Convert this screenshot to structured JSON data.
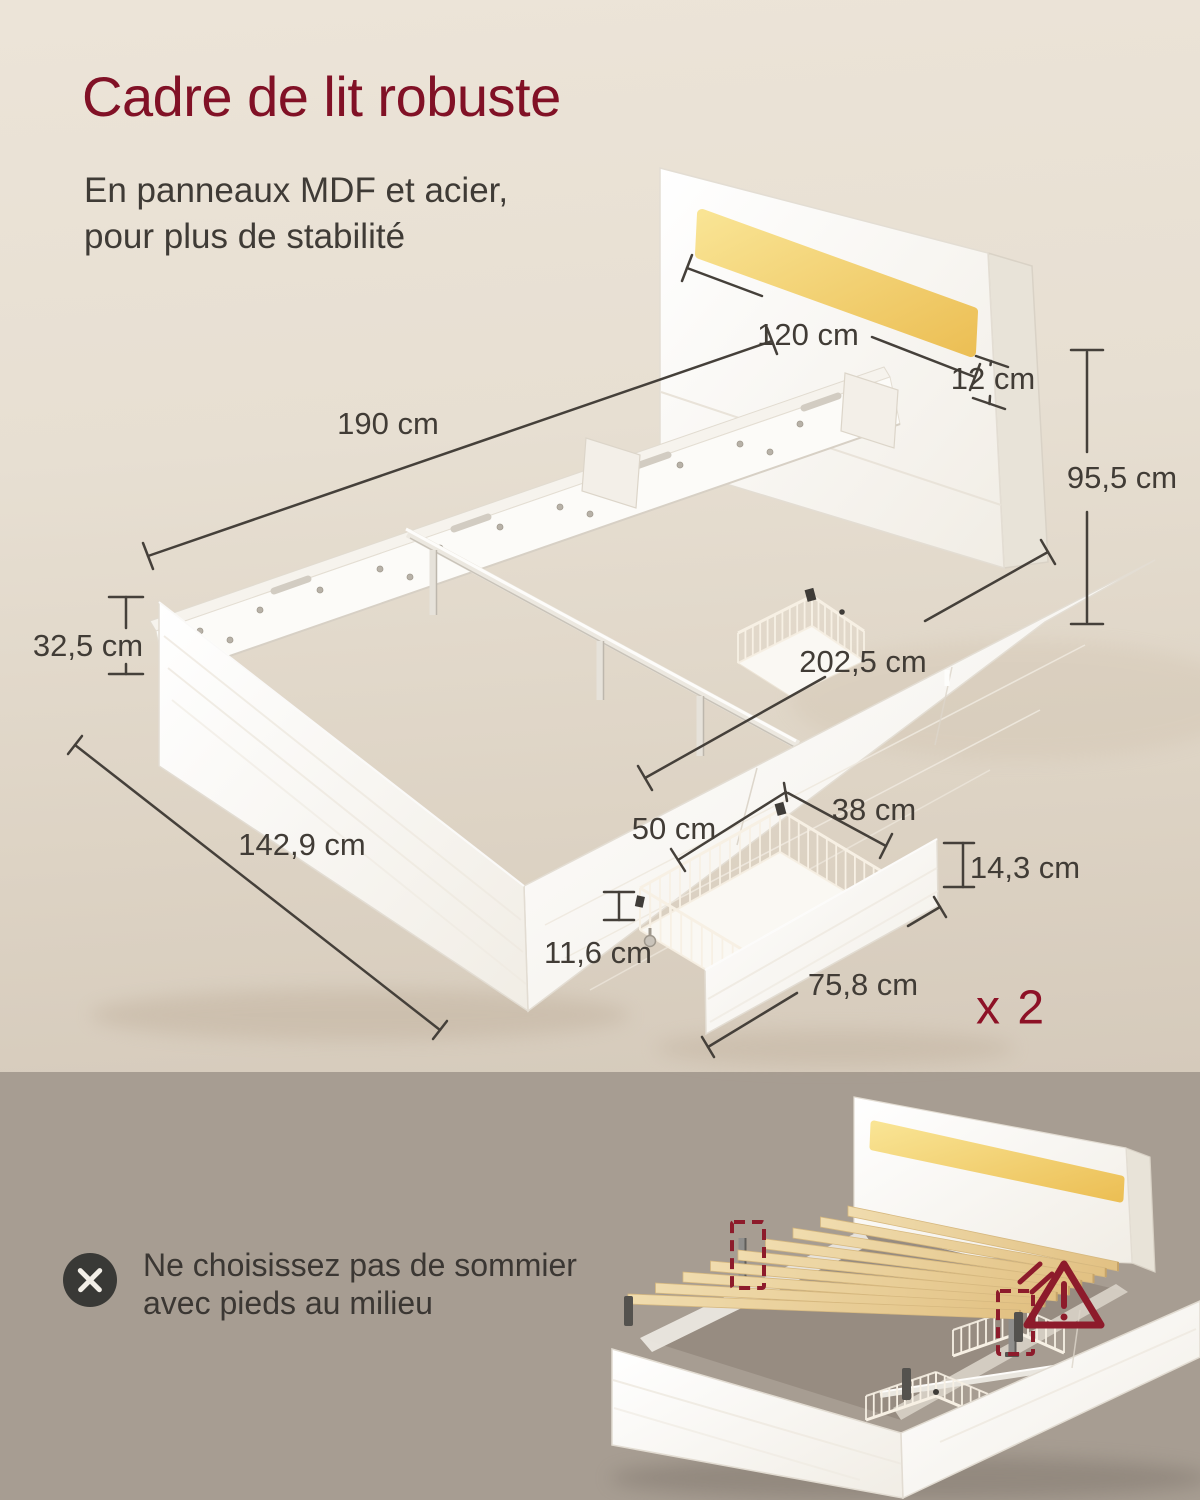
{
  "header": {
    "title": "Cadre de lit robuste",
    "subtitle_line1": "En panneaux MDF et acier,",
    "subtitle_line2": "pour plus de stabilité"
  },
  "diagram": {
    "dimensions": [
      {
        "id": "frame-length",
        "label": "190 cm"
      },
      {
        "id": "led-strip-width",
        "label": "120 cm"
      },
      {
        "id": "led-strip-height",
        "label": "12 cm"
      },
      {
        "id": "headboard-height",
        "label": "95,5 cm"
      },
      {
        "id": "frame-height",
        "label": "32,5 cm"
      },
      {
        "id": "total-length",
        "label": "202,5 cm"
      },
      {
        "id": "frame-width",
        "label": "142,9 cm"
      },
      {
        "id": "drawer-depth",
        "label": "50 cm"
      },
      {
        "id": "drawer-width",
        "label": "38 cm"
      },
      {
        "id": "drawer-front-height",
        "label": "14,3 cm"
      },
      {
        "id": "basket-height",
        "label": "11,6 cm"
      },
      {
        "id": "drawer-front-width",
        "label": "75,8 cm"
      }
    ],
    "quantity_label": "x 2"
  },
  "warning": {
    "icon": "cross-circle-icon",
    "note_line1": "Ne choisissez pas de sommier",
    "note_line2": "avec pieds au milieu"
  },
  "colors": {
    "accent_red": "#8d1126",
    "warning_red": "#8d1b2b",
    "led_yellow": "#f2cf6b",
    "slat_wood": "#e8cf9d",
    "background_top": "#e9e1d5",
    "background_bottom": "#a79d92",
    "text_dark": "#3e3a35"
  }
}
